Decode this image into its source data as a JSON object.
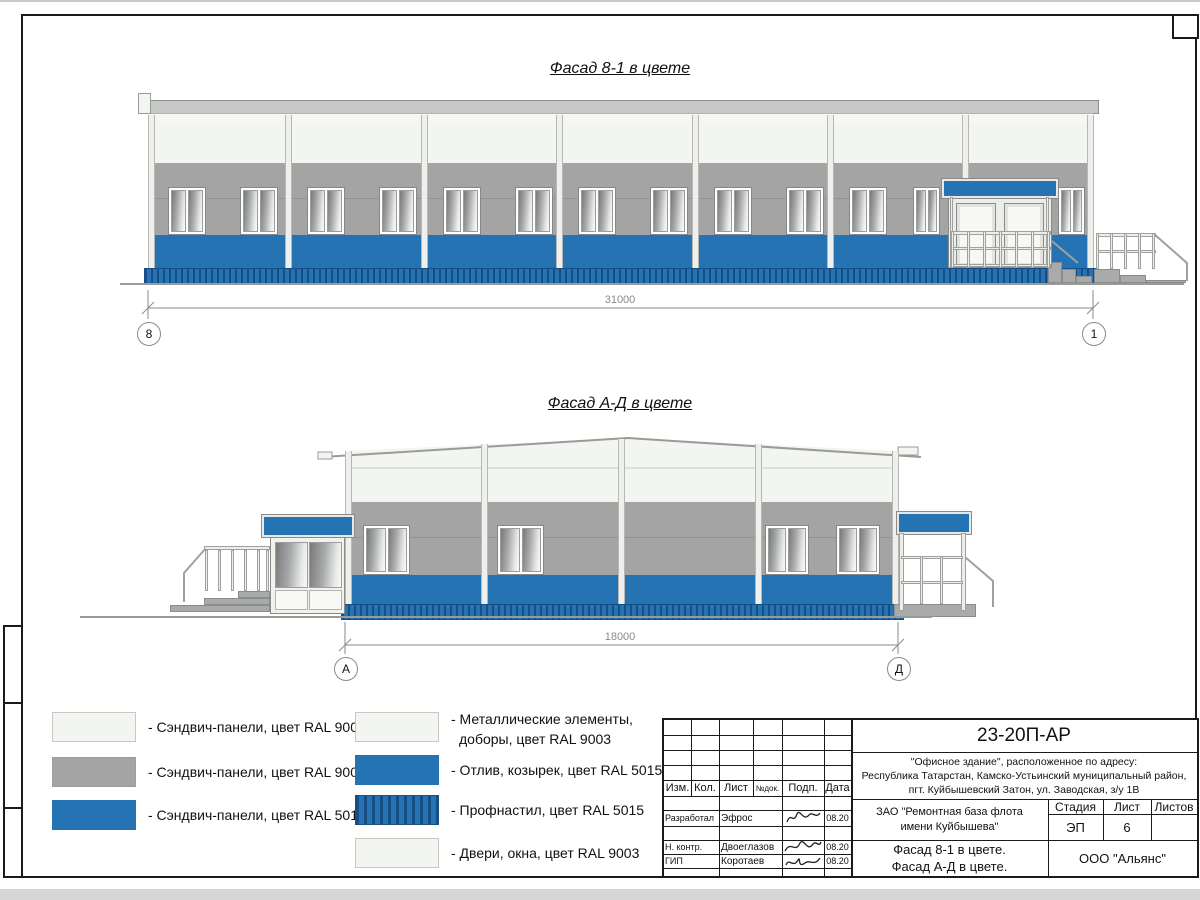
{
  "sheet": {
    "facade1": {
      "title": "Фасад 8-1 в цвете",
      "dimension": "31000",
      "axis_left": "8",
      "axis_right": "1"
    },
    "facade2": {
      "title": "Фасад А-Д в цвете",
      "dimension": "18000",
      "axis_left": "А",
      "axis_right": "Д"
    },
    "legend": {
      "items_left": [
        {
          "label": "- Сэндвич-панели, цвет RAL 9003"
        },
        {
          "label": "- Сэндвич-панели, цвет RAL 9006"
        },
        {
          "label": "- Сэндвич-панели, цвет RAL 5015"
        }
      ],
      "items_right": [
        {
          "label": "- Металлические элементы,",
          "label2": "доборы, цвет RAL 9003"
        },
        {
          "label": "- Отлив, козырек, цвет RAL 5015"
        },
        {
          "label": "- Профнастил, цвет RAL 5015"
        },
        {
          "label": "- Двери, окна, цвет RAL 9003"
        }
      ]
    },
    "titleblock": {
      "doc_number": "23-20П-АР",
      "address1": "\"Офисное здание\", расположенное по адресу:",
      "address2": "Республика Татарстан, Камско-Устьинский муниципальный район,",
      "address3": "пгт. Куйбышевский Затон, ул. Заводская, з/у 1В",
      "client1": "ЗАО \"Ремонтная база флота",
      "client2": "имени Куйбышева\"",
      "sheet_name1": "Фасад 8-1 в цвете.",
      "sheet_name2": "Фасад А-Д в цвете.",
      "company": "ООО \"Альянс\"",
      "col_izm": "Изм.",
      "col_kol": "Кол.",
      "col_list": "Лист",
      "col_ndok": "№док.",
      "col_podp": "Подп.",
      "col_data": "Дата",
      "h_stadia": "Стадия",
      "h_list": "Лист",
      "h_listov": "Листов",
      "stadia": "ЭП",
      "list_no": "6",
      "listov": "",
      "row1_role": "Разработал",
      "row1_name": "Эфрос",
      "row1_date": "08.20",
      "row2_role": "Н. контр.",
      "row2_name": "Двоеглазов",
      "row2_date": "08.20",
      "row3_role": "ГИП",
      "row3_name": "Коротаев",
      "row3_date": "08.20"
    },
    "colors": {
      "ral5015": "#2673b3",
      "ral9006": "#a3a4a3",
      "ral9003": "#f3f5f0"
    }
  }
}
